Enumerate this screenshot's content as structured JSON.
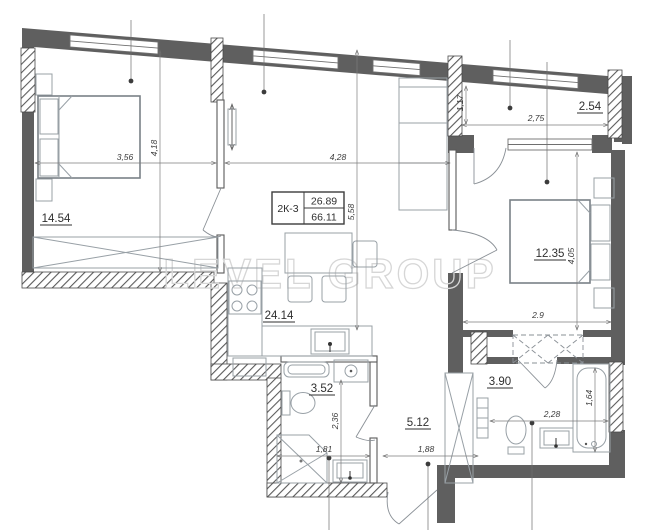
{
  "watermark": "LEVEL GROUP",
  "unit_card": {
    "code": "2К-3",
    "upper_area": "26.89",
    "lower_area": "66.11"
  },
  "areas": {
    "bedroom1": "14.54",
    "kitchen_living": "24.14",
    "bedroom2": "12.35",
    "hallway": "5.12",
    "bathroom1": "3.52",
    "bathroom2": "3.90",
    "balcony": "2.54"
  },
  "dims": {
    "bedroom1_width": "3,56",
    "bedroom1_depth": "4,18",
    "living_width": "4,28",
    "living_depth": "5,58",
    "balcony_width": "2,75",
    "balcony_depth": "1,17",
    "bedroom2_width": "2.9",
    "bedroom2_depth": "4,05",
    "bathroom1_depth": "2,36",
    "bathroom1_width": "1,81",
    "hall_width": "1,88",
    "bathroom2_width": "2,28",
    "bathtub_length": "1,64"
  },
  "colors": {
    "wall": "#5f5f5f",
    "furniture_line": "#98a0a6",
    "dimension_text": "#3c3c3c",
    "watermark": "#d6d6d6"
  }
}
